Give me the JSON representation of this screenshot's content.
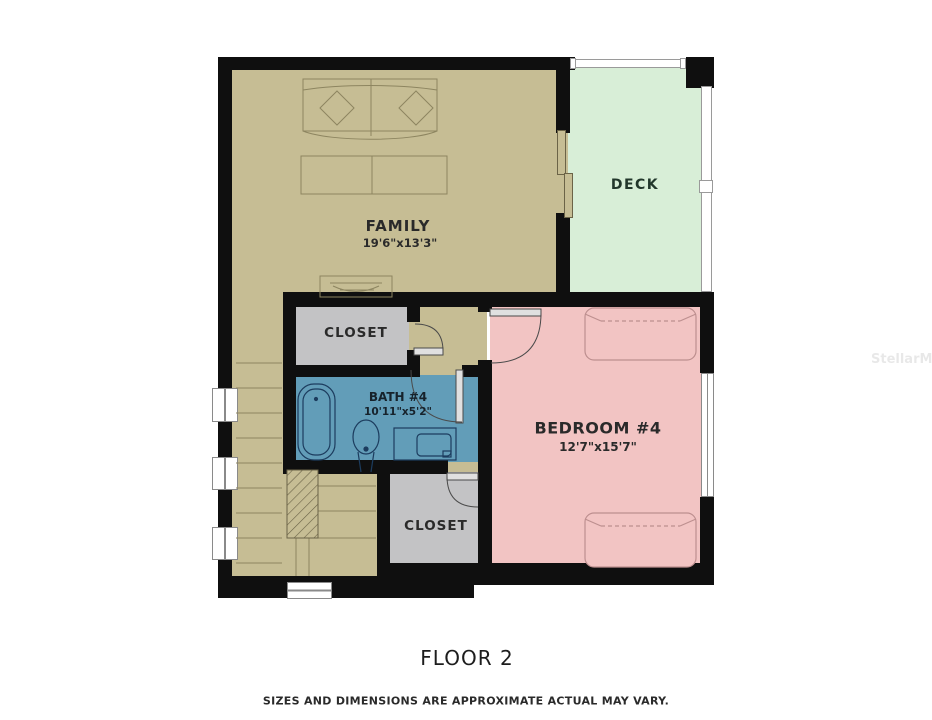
{
  "plan": {
    "rooms": {
      "family": {
        "name": "FAMILY",
        "dims": "19'6\"x13'3\""
      },
      "deck": {
        "name": "DECK"
      },
      "bedroom4": {
        "name": "BEDROOM #4",
        "dims": "12'7\"x15'7\""
      },
      "bath4": {
        "name": "BATH #4",
        "dims": "10'11\"x5'2\""
      },
      "closet_upper": {
        "name": "CLOSET"
      },
      "closet_lower": {
        "name": "CLOSET"
      }
    },
    "colors": {
      "family": "#c6bd94",
      "deck": "#d8eed7",
      "bedroom": "#f2c4c3",
      "bath": "#629db8",
      "closet": "#c3c3c5",
      "wall": "#0f0f0f"
    }
  },
  "footer": {
    "floor_label": "FLOOR 2",
    "disclaimer": "SIZES AND DIMENSIONS ARE APPROXIMATE ACTUAL MAY VARY."
  },
  "watermark": {
    "text": "StellarMLS"
  }
}
